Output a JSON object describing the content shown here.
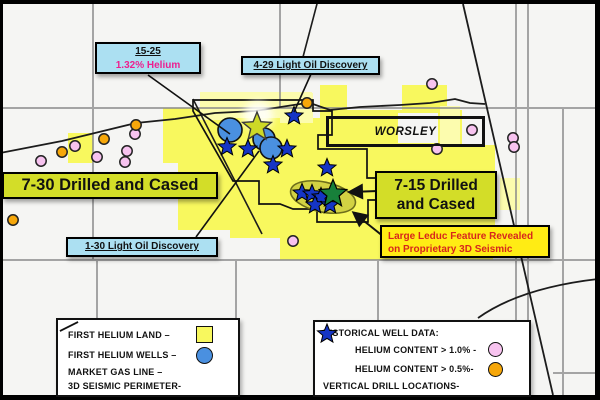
{
  "annotations": {
    "well_15_25": {
      "title": "15-25",
      "subtitle": "1.32% Helium"
    },
    "discovery_4_29": "4-29 Light Oil Discovery",
    "discovery_1_30": "1-30 Light Oil Discovery",
    "drilled_7_30": "7-30 Drilled and Cased",
    "drilled_7_15_line1": "7-15 Drilled",
    "drilled_7_15_line2": "and Cased",
    "leduc_line1": "Large Leduc Feature Revealed",
    "leduc_line2": "on Proprietary 3D Seismic",
    "area_name": "WORSLEY"
  },
  "legend_left": {
    "items": [
      {
        "label": "FIRST HELIUM LAND –",
        "symbol": "yellow-square"
      },
      {
        "label": "FIRST HELIUM WELLS –",
        "symbol": "blue-circle"
      },
      {
        "label": "MARKET GAS LINE –",
        "symbol": "diagonal-line"
      },
      {
        "label": "3D SEISMIC PERIMETER-",
        "symbol": "diagonal-line"
      }
    ]
  },
  "legend_right": {
    "title": "HISTORICAL WELL DATA:",
    "items": [
      {
        "label": "HELIUM CONTENT > 1.0% -",
        "symbol": "pink-circle"
      },
      {
        "label": "HELIUM CONTENT > 0.5%-",
        "symbol": "orange-circle"
      },
      {
        "label": "VERTICAL DRILL LOCATIONS-",
        "symbol": "blue-star"
      }
    ]
  },
  "colors": {
    "land_yellow": "#f8f85e",
    "land_yellow_light": "#fcfcae",
    "label_chartreuse": "#d3dd28",
    "leduc_yellow": "#ffec14",
    "leduc_red_text": "#d7261c",
    "callout_cyan": "#ace0f2",
    "helium_magenta": "#ed1f8f",
    "well_blue": "#4a90e0",
    "star_blue": "#1535c5",
    "star_green": "#17803a",
    "star_lime": "#cdd926",
    "dot_pink": "#f7c3ef",
    "dot_orange": "#f6a70a"
  },
  "map_markers": {
    "helium_gt_1_wells": [
      [
        41,
        161
      ],
      [
        75,
        146
      ],
      [
        97,
        157
      ],
      [
        125,
        162
      ],
      [
        127,
        151
      ],
      [
        135,
        134
      ],
      [
        293,
        241
      ],
      [
        432,
        84
      ],
      [
        472,
        130
      ],
      [
        437,
        149
      ],
      [
        513,
        138
      ],
      [
        514,
        147
      ]
    ],
    "helium_gt_05_wells": [
      [
        13,
        220
      ],
      [
        62,
        152
      ],
      [
        104,
        139
      ],
      [
        136,
        125
      ],
      [
        307,
        103
      ]
    ],
    "first_helium_wells": [
      [
        230,
        130,
        12
      ],
      [
        264,
        139,
        11
      ],
      [
        271,
        148,
        11
      ]
    ],
    "vertical_drill_locations": [
      [
        227,
        147
      ],
      [
        248,
        149
      ],
      [
        287,
        149
      ],
      [
        273,
        165
      ],
      [
        294,
        116
      ],
      [
        327,
        168
      ],
      [
        302,
        193
      ],
      [
        312,
        194
      ],
      [
        321,
        197
      ],
      [
        315,
        205
      ],
      [
        330,
        205
      ]
    ],
    "lime_star": [
      257,
      127
    ],
    "green_star": [
      333,
      194
    ],
    "leduc_ellipse": {
      "cx": 323,
      "cy": 197,
      "rx": 33,
      "ry": 15,
      "rotate": 12
    }
  }
}
